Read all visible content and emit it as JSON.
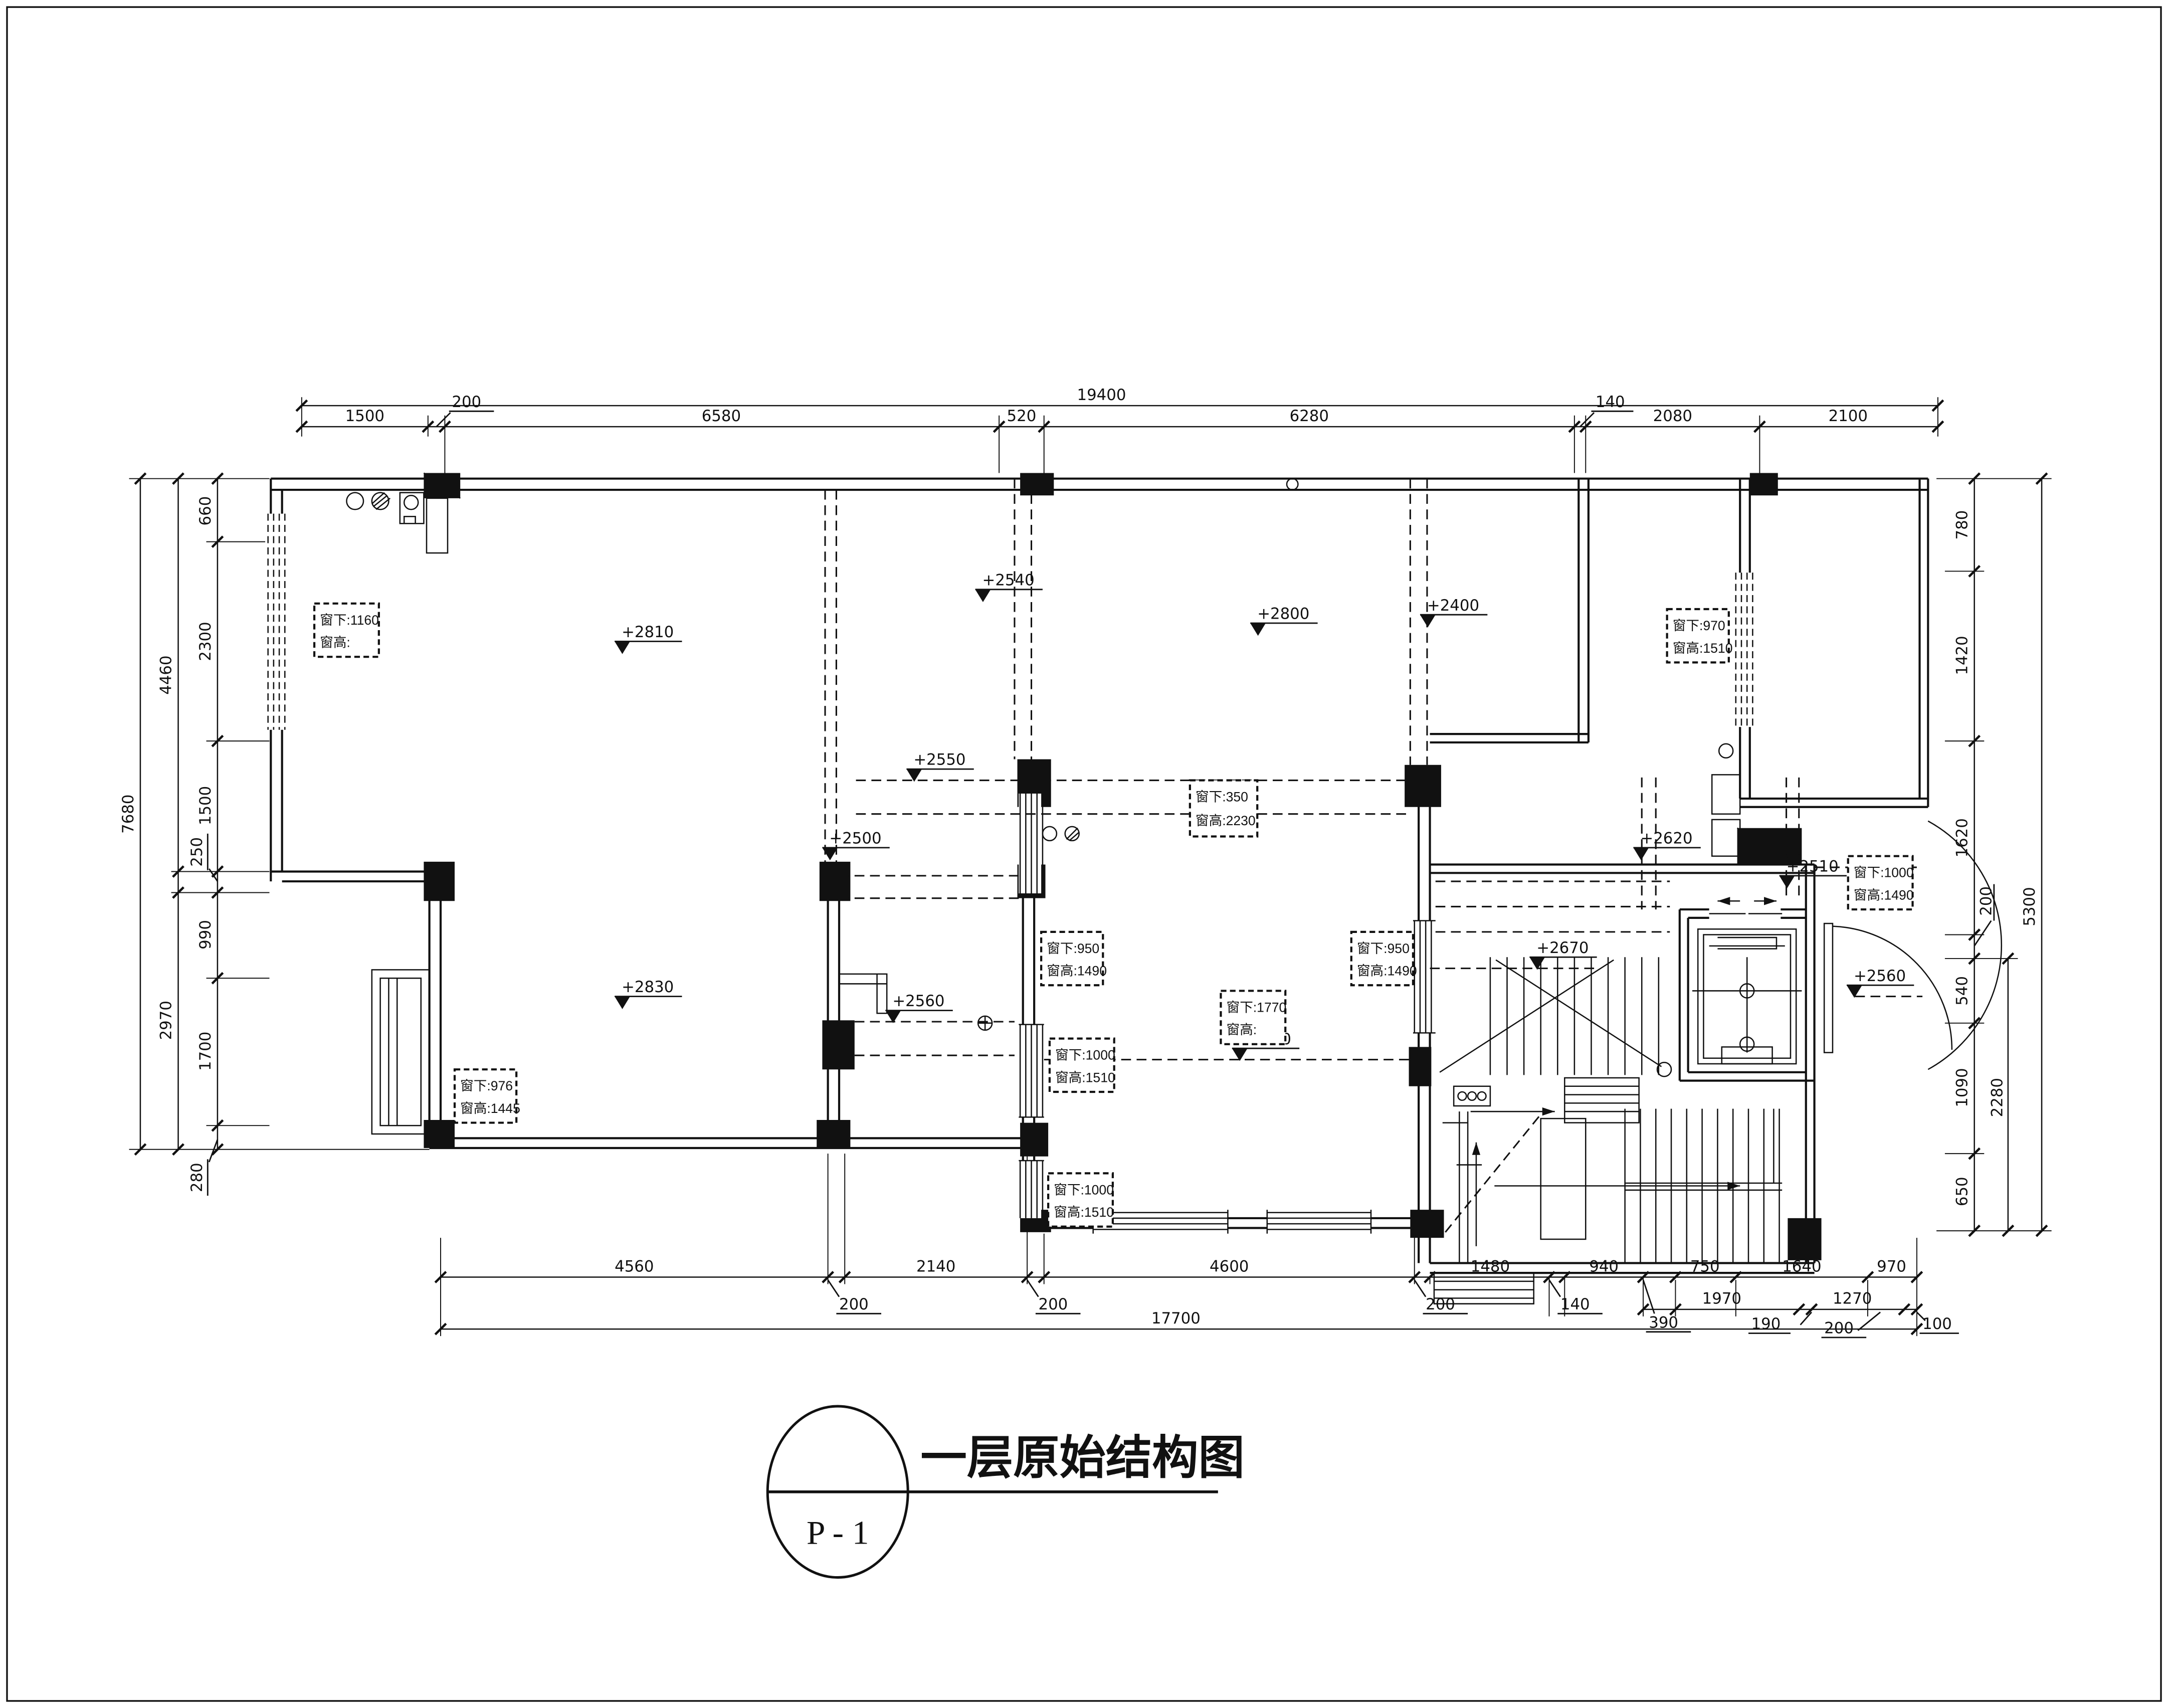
{
  "title": {
    "name": "一层原始结构图",
    "sheet": "P - 1"
  },
  "dims": {
    "top": {
      "total": "19400",
      "row": [
        "1500",
        "200",
        "6580",
        "520",
        "6280",
        "140",
        "2080",
        "2100"
      ]
    },
    "left": {
      "total": "7680",
      "mid": [
        "4460",
        "2970"
      ],
      "row": [
        "660",
        "2300",
        "1500",
        "250",
        "990",
        "1700",
        "280"
      ]
    },
    "right": {
      "total": "5300",
      "mid": [
        "200",
        "2280"
      ],
      "row": [
        "780",
        "1420",
        "1620",
        "540",
        "1090",
        "650"
      ]
    },
    "bottom": {
      "total": "17700",
      "row": [
        "4560",
        "200",
        "2140",
        "200",
        "4600",
        "200",
        "1480",
        "140",
        "940",
        "750",
        "1640",
        "970"
      ],
      "row2": [
        "390",
        "1970",
        "190",
        "1270",
        "200",
        "100"
      ]
    }
  },
  "elevations": [
    "+2810",
    "+2540",
    "+2800",
    "+2400",
    "+2550",
    "+2500",
    "+2560",
    "+2540",
    "+2830",
    "+2620",
    "+2670",
    "+2510",
    "+2560"
  ],
  "windows": [
    {
      "l1": "窗下:1160",
      "l2": "窗高:"
    },
    {
      "l1": "窗下:970",
      "l2": "窗高:1510"
    },
    {
      "l1": "窗下:350",
      "l2": "窗高:2230"
    },
    {
      "l1": "窗下:950",
      "l2": "窗高:1490"
    },
    {
      "l1": "窗下:950",
      "l2": "窗高:1490"
    },
    {
      "l1": "窗下:1000",
      "l2": "窗高:1490"
    },
    {
      "l1": "窗下:1770",
      "l2": "窗高:"
    },
    {
      "l1": "窗下:1000",
      "l2": "窗高:1510"
    },
    {
      "l1": "窗下:1000",
      "l2": "窗高:1510"
    },
    {
      "l1": "窗下:976",
      "l2": "窗高:1445"
    }
  ]
}
